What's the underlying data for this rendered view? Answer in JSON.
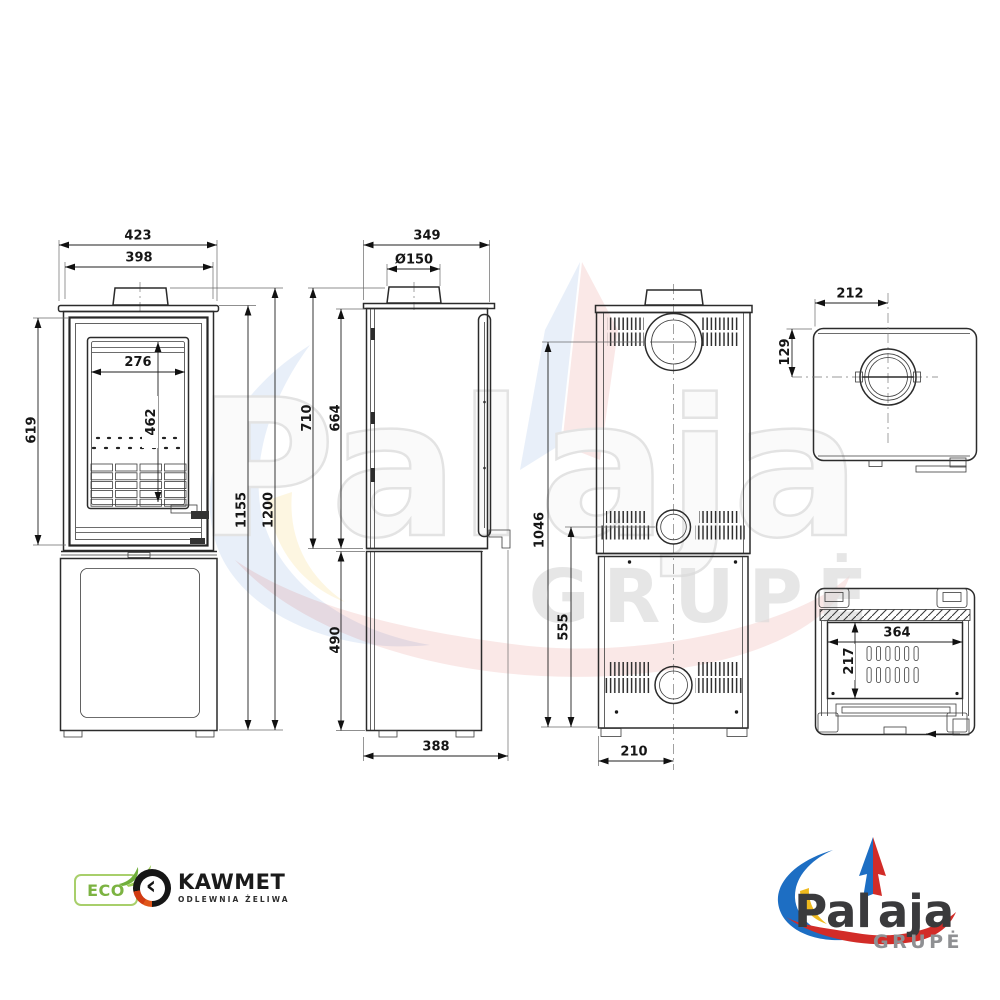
{
  "views": {
    "front": {
      "dim_top_width": "423",
      "dim_inner_width": "398",
      "dim_glass_width": "276",
      "dim_glass_height": "462",
      "dim_door_height": "619",
      "dim_body_height": "1155",
      "dim_total_height": "1200"
    },
    "side": {
      "dim_depth": "349",
      "dim_flue": "Ø150",
      "dim_upper_outer": "710",
      "dim_upper_inner": "664",
      "dim_base": "490",
      "dim_bottom_depth": "388"
    },
    "back": {
      "dim_flue_height": "1046",
      "dim_outlet_height": "555",
      "dim_center_offset": "210"
    },
    "top": {
      "dim_flue_x": "212",
      "dim_flue_y": "129"
    },
    "bottom": {
      "dim_grate_width": "364",
      "dim_grate_depth": "217"
    }
  },
  "watermark": {
    "word_left": "Pal",
    "word_right": "aja",
    "subtitle": "GRUPĖ"
  },
  "logos": {
    "eco": {
      "label": "ECO"
    },
    "kawmet": {
      "name": "KAWMET",
      "subtitle": "ODLEWNIA ŻELIWA",
      "mark": "‹"
    },
    "palaja": {
      "word_left": "Pal",
      "word_right": "aja",
      "subtitle": "GRUPĖ"
    }
  }
}
